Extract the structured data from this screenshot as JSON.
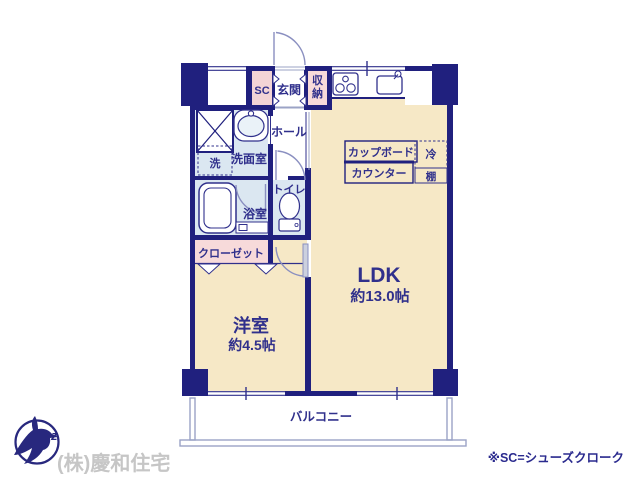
{
  "meta": {
    "type": "apartment-floor-plan",
    "colors": {
      "wall": "#20207e",
      "room_beige": "#f6e8c6",
      "room_wet_blue": "#dbe7f1",
      "room_pink": "#f7dada",
      "label_navy": "#30308c",
      "balcony_line": "#9ba3c6",
      "company_gray": "#c6c6c6"
    }
  },
  "rooms": {
    "ldk": "LDK",
    "ldk_size": "約13.0帖",
    "western": "洋室",
    "western_size": "約4.5帖",
    "entrance": "玄関",
    "shoe_closet": "SC",
    "storage": "収納",
    "storage_chars": [
      "収",
      "納"
    ],
    "hall": "ホール",
    "washroom": "洗面室",
    "washer": "洗",
    "bathroom": "浴室",
    "toilet": "トイレ",
    "closet": "クローゼット",
    "balcony": "バルコニー"
  },
  "kitchen": {
    "cupboard": "カップボード",
    "counter": "カウンター",
    "fridge": "冷",
    "shelf": "棚"
  },
  "footer": {
    "company": "(株)慶和住宅",
    "note": "※SC=シューズクローク",
    "logo_letter": "z"
  }
}
